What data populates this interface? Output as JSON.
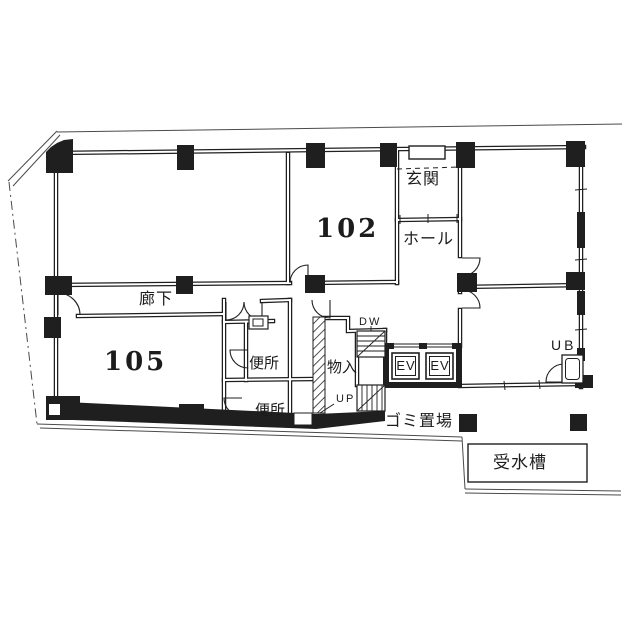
{
  "title": "1F floor plan",
  "labels": {
    "room_102": "102",
    "room_105": "105",
    "entrance": "玄関",
    "hall": "ホール",
    "corridor": "廊下",
    "toilet_upper": "便所",
    "toilet_lower": "便所",
    "storage": "物入",
    "stairs_down": "DW",
    "stairs_up": "UP",
    "elevator_1": "EV",
    "elevator_2": "EV",
    "unit_bath": "UB",
    "garbage_area": "ゴミ置場",
    "water_tank": "受水槽"
  },
  "colors": {
    "ink": "#1f1f1f",
    "paper": "#ffffff"
  }
}
